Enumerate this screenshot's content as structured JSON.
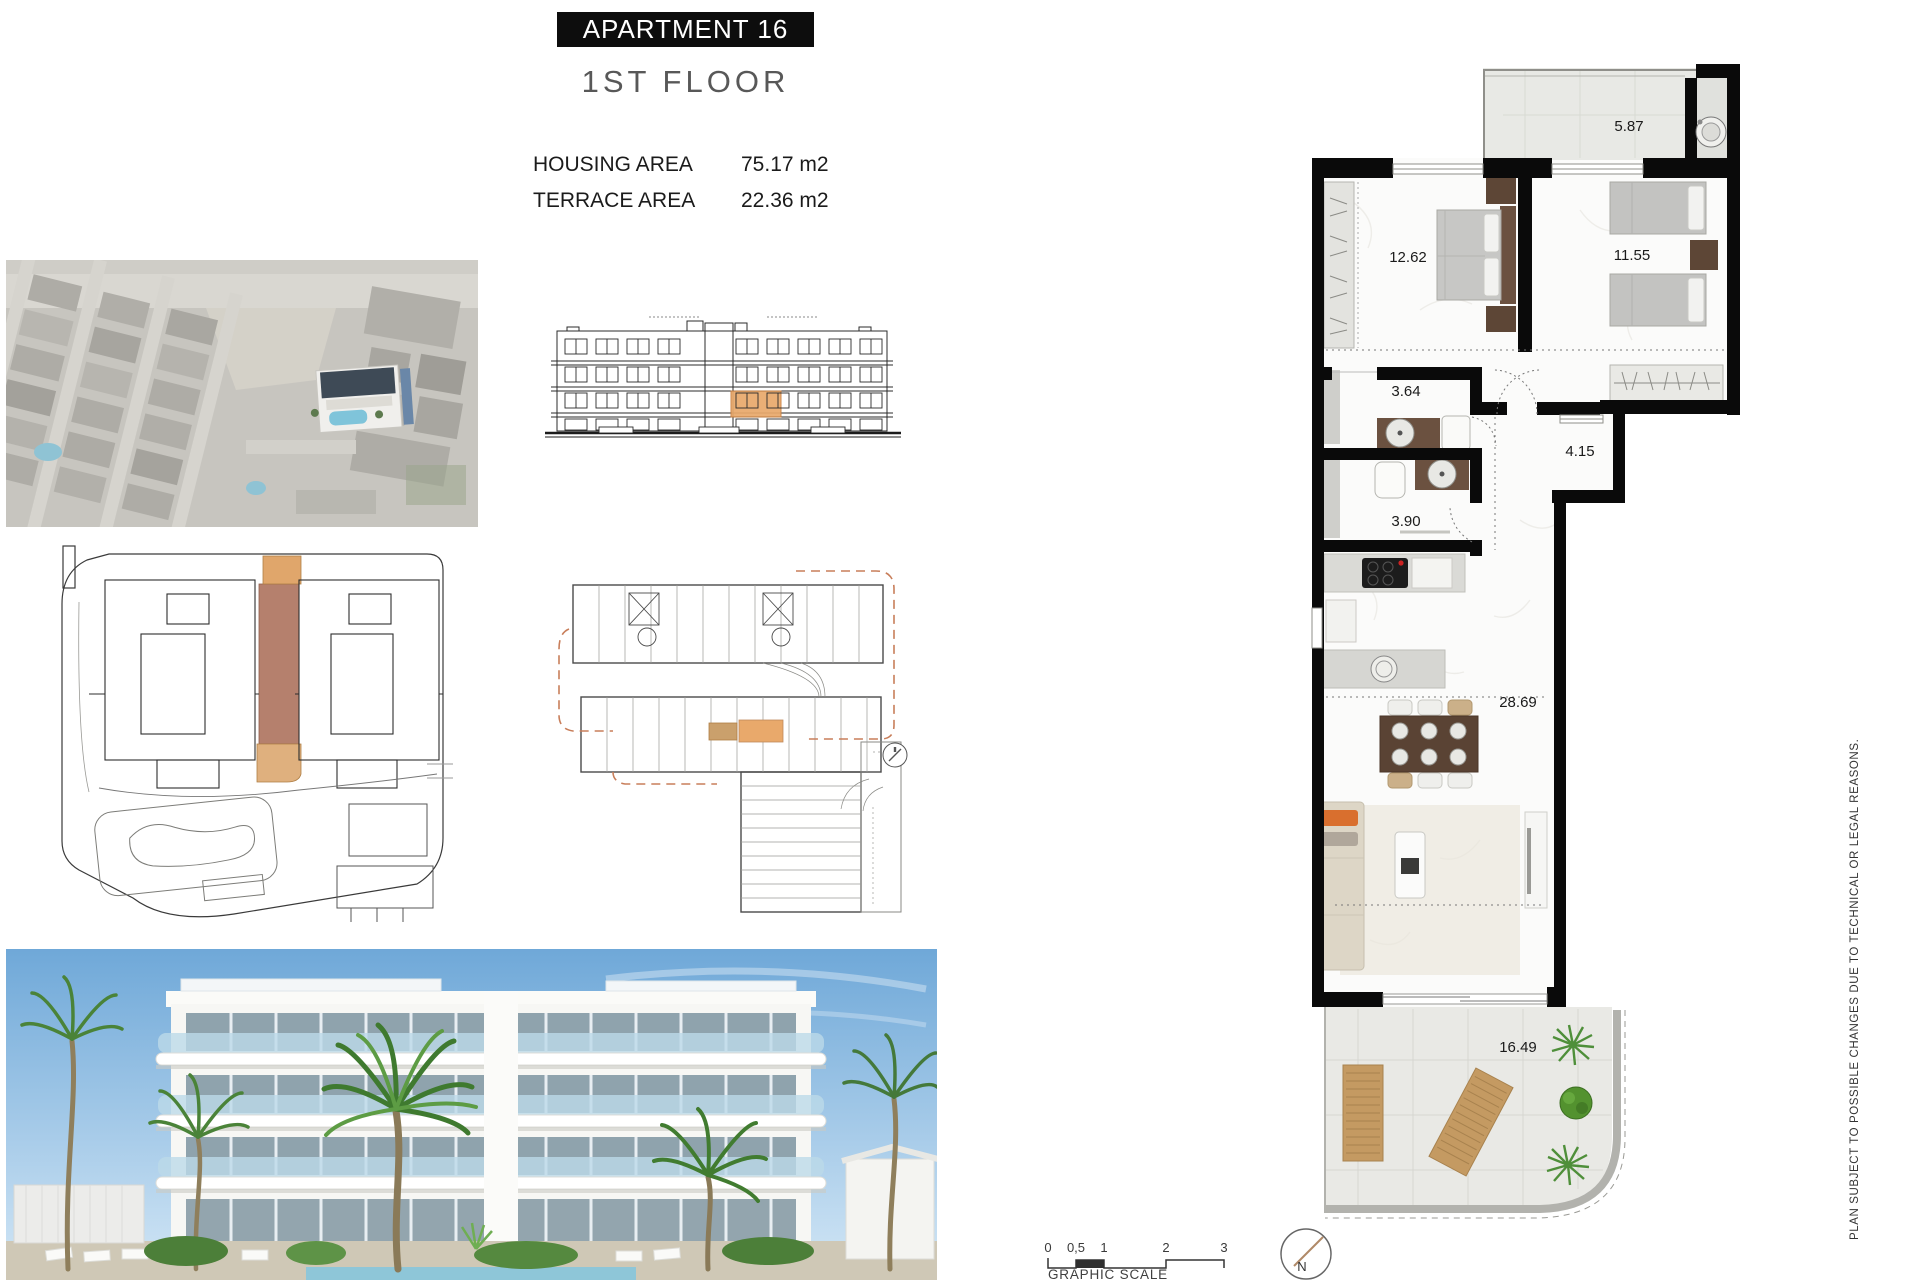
{
  "header": {
    "title": "APARTMENT 16",
    "subtitle": "1ST FLOOR",
    "areas": [
      {
        "label": "HOUSING AREA",
        "value": "75.17 m2"
      },
      {
        "label": "TERRACE AREA",
        "value": "22.36 m2"
      }
    ]
  },
  "apartment_plan": {
    "room_areas": {
      "terrace_top": "5.87",
      "bedroom_main": "12.62",
      "bedroom_second": "11.55",
      "bathroom_1": "3.64",
      "hall": "4.15",
      "bathroom_2": "3.90",
      "living_kitchen": "28.69",
      "terrace_main": "16.49"
    }
  },
  "scale_bar": {
    "label": "GRAPHIC SCALE",
    "ticks": [
      "0",
      "0,5",
      "1",
      "2",
      "3"
    ]
  },
  "compass": {
    "label": "N"
  },
  "disclaimer": "PLAN SUBJECT TO POSSIBLE CHANGES DUE TO TECHNICAL OR LEGAL REASONS.",
  "colors": {
    "wall": "#0a0a0a",
    "highlight_strip": "#b5806d",
    "highlight_tan_top": "#e0a66b",
    "highlight_tan_bottom": "#dfb07e",
    "highlight_unit": "#e9a96b",
    "dashed_outline": "#c87e5a",
    "pool_blue": "#7fc4da",
    "accent_orange": "#d96f2e"
  }
}
